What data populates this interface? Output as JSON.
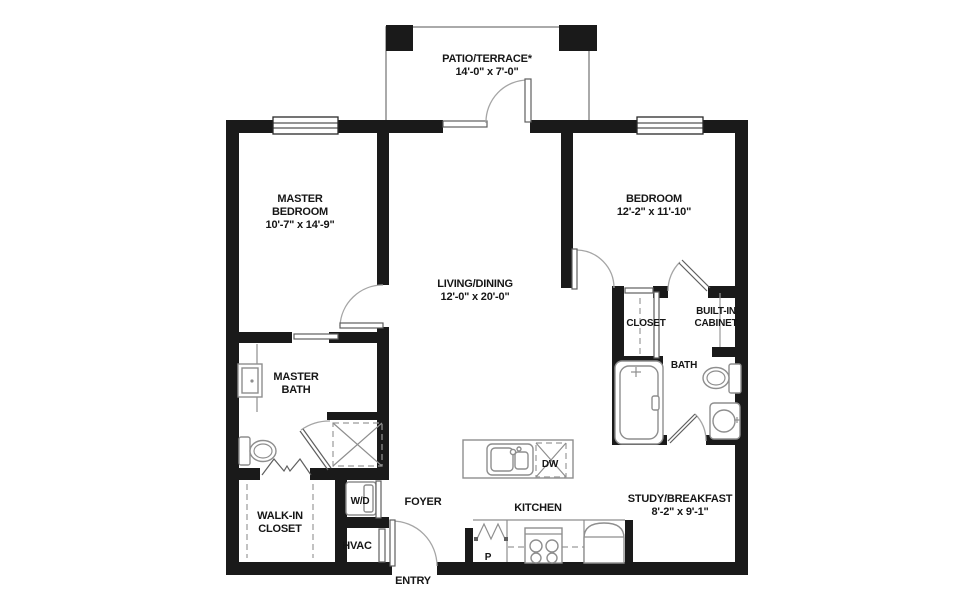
{
  "colors": {
    "wall": "#1a1a1a",
    "fixture_line": "#8e8e8e",
    "text": "#161616",
    "background": "#ffffff"
  },
  "rooms": {
    "patio": {
      "name": "PATIO/TERRACE*",
      "dims": "14'-0\" x 7'-0\""
    },
    "master_bedroom": {
      "line1": "MASTER",
      "line2": "BEDROOM",
      "dims": "10'-7\" x 14'-9\""
    },
    "bedroom": {
      "name": "BEDROOM",
      "dims": "12'-2\" x 11'-10\""
    },
    "living_dining": {
      "name": "LIVING/DINING",
      "dims": "12'-0\" x 20'-0\""
    },
    "closet": {
      "name": "CLOSET"
    },
    "built_in_cabinet": {
      "line1": "BUILT-IN",
      "line2": "CABINET"
    },
    "bath": {
      "name": "BATH"
    },
    "master_bath": {
      "line1": "MASTER",
      "line2": "BATH"
    },
    "walk_in_closet": {
      "line1": "WALK-IN",
      "line2": "CLOSET"
    },
    "laundry": {
      "name": "W/D"
    },
    "hvac": {
      "name": "HVAC"
    },
    "foyer": {
      "name": "FOYER"
    },
    "kitchen": {
      "name": "KITCHEN"
    },
    "entry": {
      "name": "ENTRY"
    },
    "study_breakfast": {
      "name": "STUDY/BREAKFAST",
      "dims": "8'-2\" x 9'-1\""
    }
  },
  "fixtures": {
    "dishwasher": {
      "label": "DW"
    },
    "pantry": {
      "label": "P"
    }
  }
}
